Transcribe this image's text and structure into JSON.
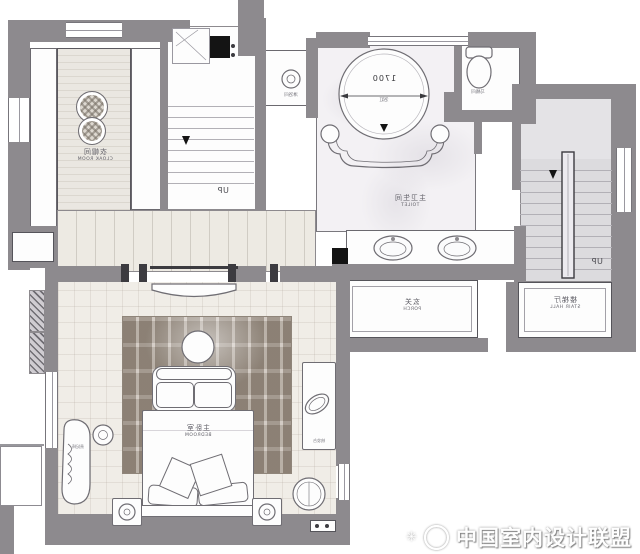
{
  "rooms": {
    "cloak_room": {
      "zh": "衣帽间",
      "en": "CLOAK ROOM"
    },
    "master_toilet": {
      "zh": "主卫生间",
      "en": "TOILET"
    },
    "porch": {
      "zh": "玄关",
      "en": "PORCH"
    },
    "stair_hall": {
      "zh": "楼梯厅",
      "en": "STAIR HALL"
    },
    "master_bedroom": {
      "zh": "主卧室",
      "en": "BEDROOM"
    },
    "shower": {
      "zh": "淋浴间"
    },
    "wc": {
      "zh": "马桶间"
    }
  },
  "furniture": {
    "bathtub": {
      "zh": "浴缸",
      "dimension": "1700"
    },
    "chaise": {
      "zh": "贵妃椅"
    },
    "dresser": {
      "zh": "梳妆台"
    }
  },
  "stairs": {
    "left_up": "UP",
    "right_up": "UP"
  },
  "watermark": {
    "text": "中国室内设计联盟",
    "sparkle": "✳",
    "logo": "cida-circle-logo"
  },
  "note": "plan-labels-mirrored-horizontally",
  "colors": {
    "wall": "#8d8a8e",
    "wall_dark": "#3c3b40",
    "floor_beige": "#f0ede7",
    "marble": "#f3f1f4",
    "rug": "#b3a79a",
    "stair_floor": "#dcdbde",
    "black": "#141414"
  }
}
